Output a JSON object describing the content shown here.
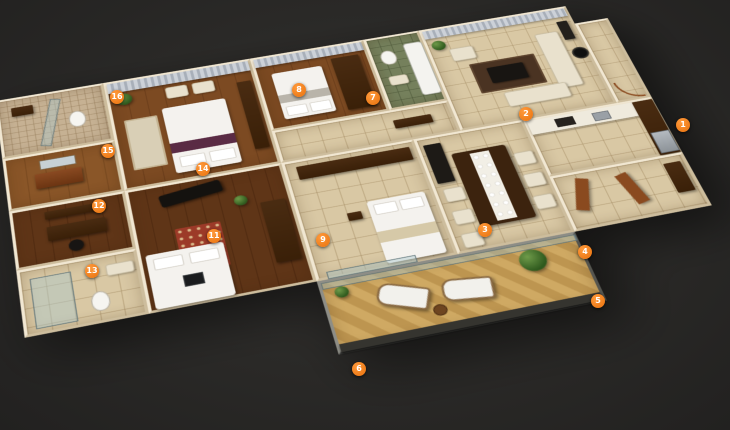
{
  "scene": {
    "background_color": "#2a2927",
    "accent_color": "#ef7d1a",
    "wall_color": "#f1e7d2",
    "wood_floor_color": "#7c4a22",
    "tile_floor_color": "#d9c8a4",
    "balcony_deck_color": "#cfa963",
    "curtain_color": "#ccd1d8",
    "bath_tile_color": "#75805c"
  },
  "markers": [
    {
      "number": "1",
      "x": 683,
      "y": 125
    },
    {
      "number": "2",
      "x": 526,
      "y": 114
    },
    {
      "number": "3",
      "x": 485,
      "y": 230
    },
    {
      "number": "4",
      "x": 585,
      "y": 252
    },
    {
      "number": "5",
      "x": 598,
      "y": 301
    },
    {
      "number": "6",
      "x": 359,
      "y": 369
    },
    {
      "number": "7",
      "x": 373,
      "y": 98
    },
    {
      "number": "8",
      "x": 299,
      "y": 90
    },
    {
      "number": "9",
      "x": 323,
      "y": 240
    },
    {
      "number": "11",
      "x": 214,
      "y": 236
    },
    {
      "number": "12",
      "x": 99,
      "y": 206
    },
    {
      "number": "13",
      "x": 92,
      "y": 271
    },
    {
      "number": "14",
      "x": 203,
      "y": 169
    },
    {
      "number": "15",
      "x": 108,
      "y": 151
    },
    {
      "number": "16",
      "x": 117,
      "y": 97
    }
  ]
}
